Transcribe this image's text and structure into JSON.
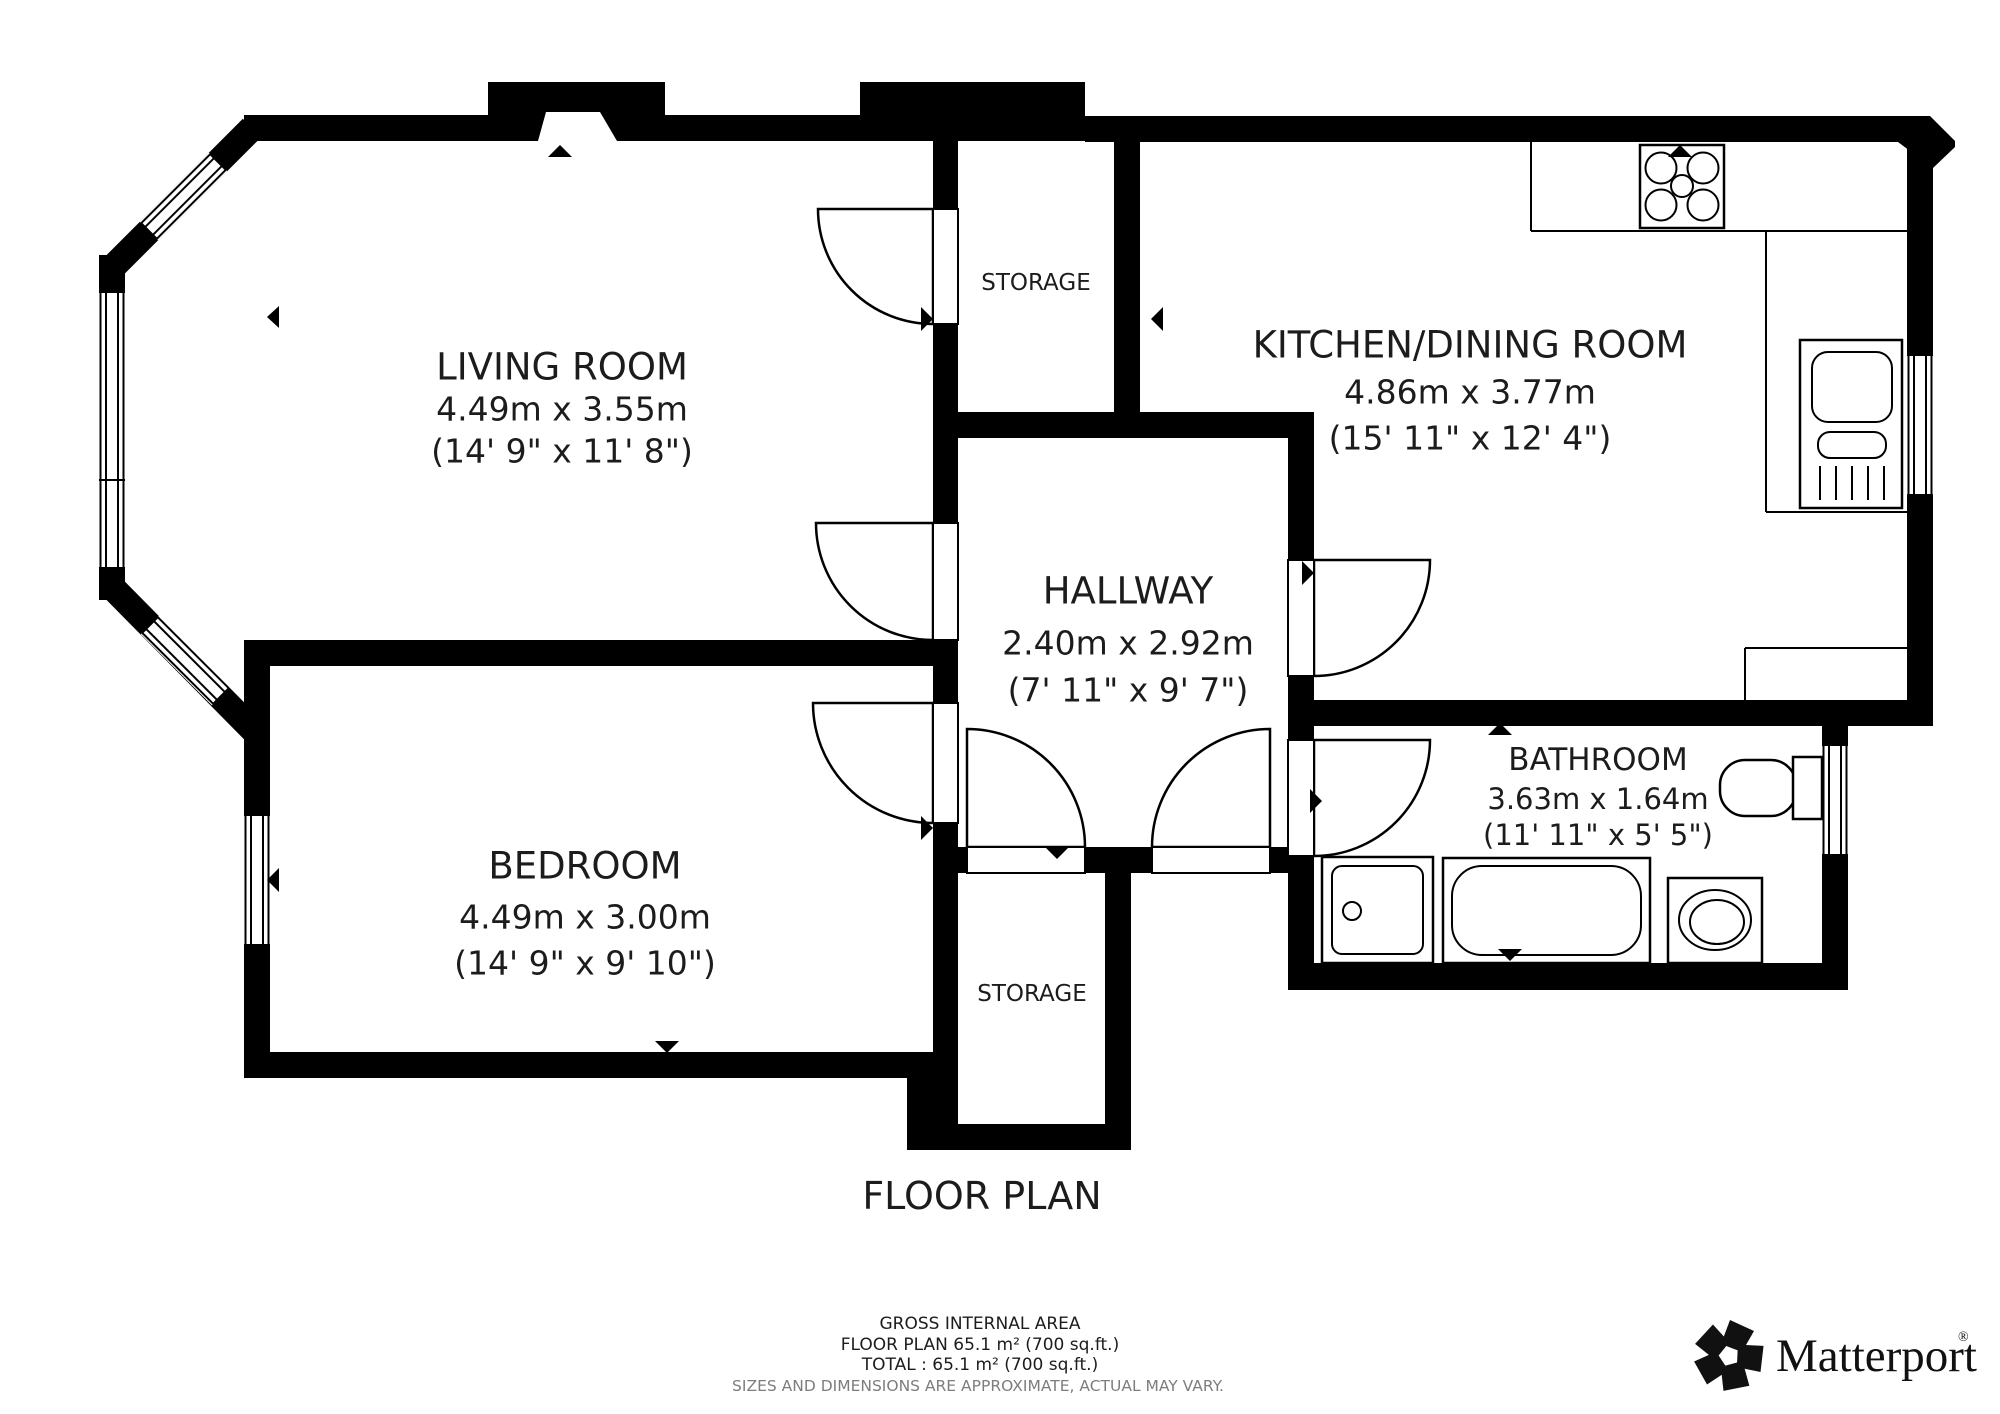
{
  "title": "FLOOR PLAN",
  "rooms": {
    "living": {
      "name": "LIVING ROOM",
      "metric": "4.49m x 3.55m",
      "imperial": "(14' 9\" x 11' 8\")"
    },
    "kitchen": {
      "name": "KITCHEN/DINING ROOM",
      "metric": "4.86m x 3.77m",
      "imperial": "(15' 11\" x 12' 4\")"
    },
    "hallway": {
      "name": "HALLWAY",
      "metric": "2.40m x 2.92m",
      "imperial": "(7' 11\" x 9' 7\")"
    },
    "bedroom": {
      "name": "BEDROOM",
      "metric": "4.49m x 3.00m",
      "imperial": "(14' 9\" x 9' 10\")"
    },
    "bathroom": {
      "name": "BATHROOM",
      "metric": "3.63m x 1.64m",
      "imperial": "(11' 11\" x 5' 5\")"
    },
    "storage_top": {
      "name": "STORAGE"
    },
    "storage_bottom": {
      "name": "STORAGE"
    }
  },
  "footer": {
    "area_heading": "GROSS INTERNAL AREA",
    "area_line": "FLOOR PLAN 65.1 m² (700 sq.ft.)",
    "total_line": "TOTAL :  65.1 m² (700 sq.ft.)",
    "disclaimer": "SIZES AND DIMENSIONS ARE APPROXIMATE, ACTUAL MAY VARY."
  },
  "brand": {
    "name": "Matterport",
    "registered": "®"
  },
  "colors": {
    "wall": "#000000",
    "text": "#1c1c1c",
    "muted": "#7d7d7d",
    "background": "#ffffff"
  }
}
